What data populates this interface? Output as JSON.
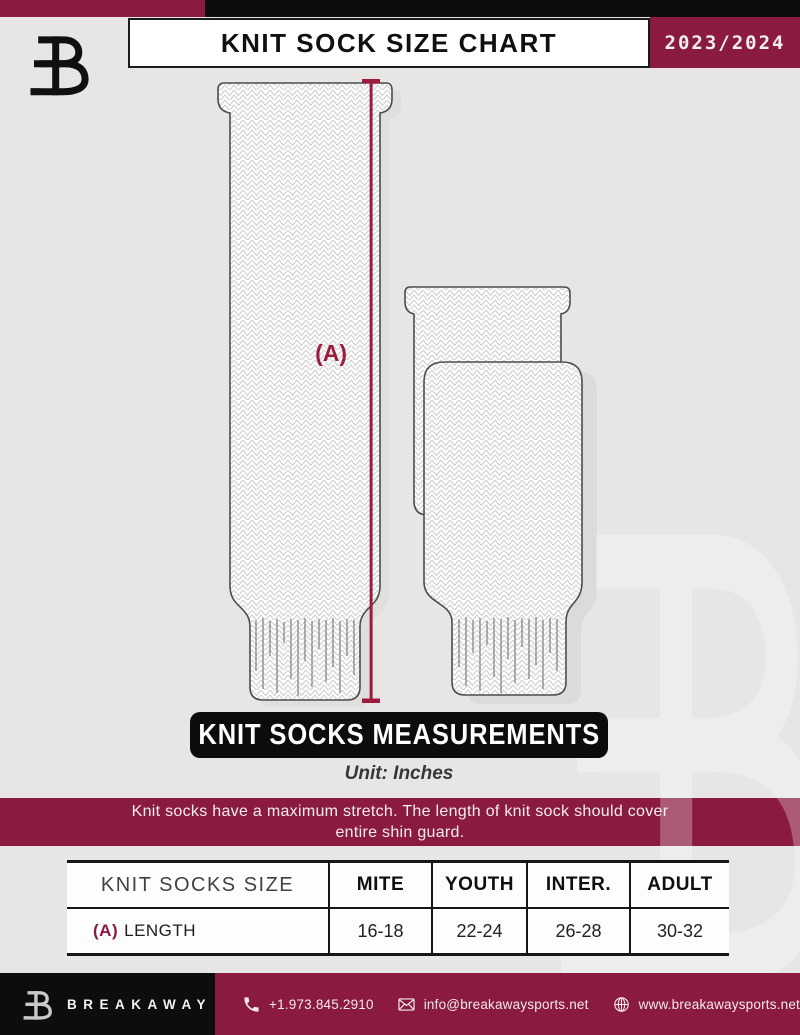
{
  "header": {
    "title": "KNIT SOCK SIZE CHART",
    "season": "2023/2024"
  },
  "diagram": {
    "measurement_label": "(A)",
    "banner": "KNIT SOCKS MEASUREMENTS",
    "unit_note": "Unit: Inches"
  },
  "notice": {
    "line1": "Knit socks have a maximum stretch. The length of knit sock should cover",
    "line2": "entire shin guard."
  },
  "size_table": {
    "columns": [
      "KNIT SOCKS SIZE",
      "MITE",
      "YOUTH",
      "INTER.",
      "ADULT"
    ],
    "rows": [
      {
        "label_prefix": "(A)",
        "label": "LENGTH",
        "values": [
          "16-18",
          "22-24",
          "26-28",
          "30-32"
        ]
      }
    ]
  },
  "footer": {
    "brand": "BREAKAWAY",
    "phone": "+1.973.845.2910",
    "email": "info@breakawaysports.net",
    "website": "www.breakawaysports.net"
  },
  "colors": {
    "maroon": "#8B1B3E",
    "accent_line": "#9C1C3E",
    "background": "#E7E6E4",
    "banner_black": "#0C0C0C",
    "sock_outline": "#4D4D4D"
  }
}
